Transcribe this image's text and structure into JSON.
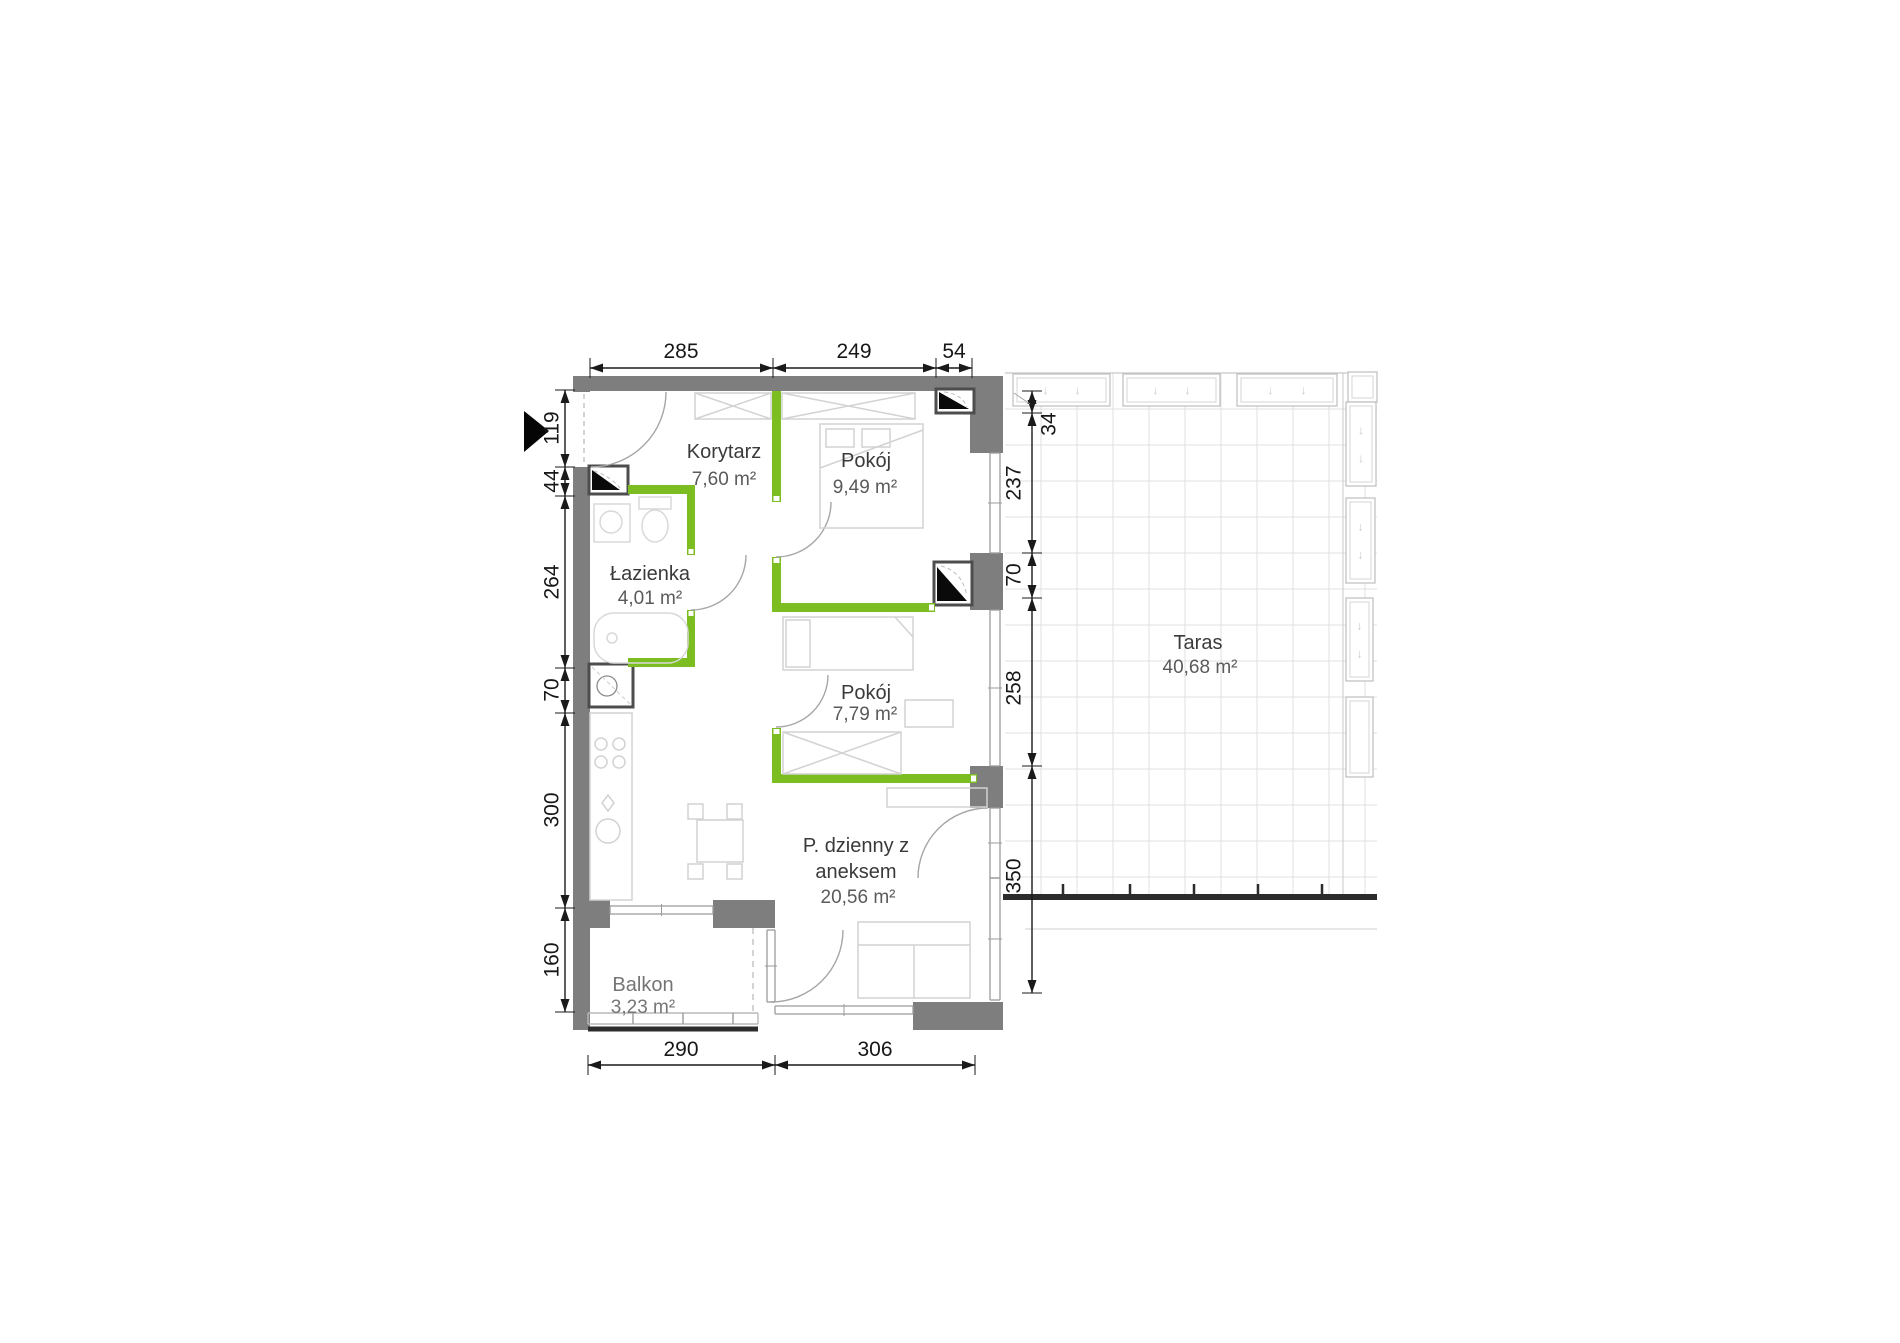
{
  "plan": {
    "rooms": {
      "korytarz": {
        "name": "Korytarz",
        "area": "7,60 m²"
      },
      "pokoj_1": {
        "name": "Pokój",
        "area": "9,49 m²"
      },
      "lazienka": {
        "name": "Łazienka",
        "area": "4,01 m²"
      },
      "pokoj_2": {
        "name": "Pokój",
        "area": "7,79 m²"
      },
      "pokoj_dzienny": {
        "name_line1": "P. dzienny z",
        "name_line2": "aneksem",
        "area": "20,56 m²"
      },
      "balkon": {
        "name": "Balkon",
        "area": "3,23 m²"
      },
      "taras": {
        "name": "Taras",
        "area": "40,68 m²"
      }
    },
    "dimensions_cm": {
      "top": [
        "285",
        "249",
        "54"
      ],
      "bottom": [
        "290",
        "306"
      ],
      "left": [
        "119",
        "44",
        "264",
        "70",
        "300",
        "160"
      ],
      "right": [
        "34",
        "237",
        "70",
        "258",
        "350"
      ]
    },
    "icons": {
      "entrance_marker": "▶",
      "planter_arrow": "↓"
    },
    "colors": {
      "wall": "#7e7e7e",
      "partition_wall": "#7cbd22",
      "dimension": "#1a1a1a",
      "balustrade": "#2c2c2c",
      "furniture_line": "#d2d2d2",
      "terrace_grid": "#e0e0e0"
    }
  }
}
